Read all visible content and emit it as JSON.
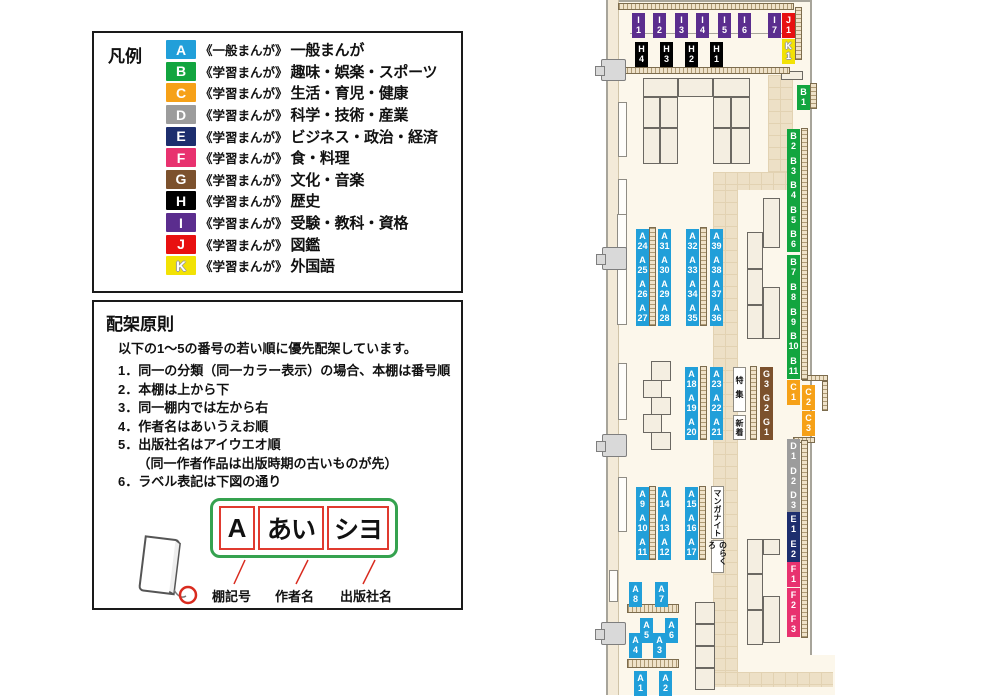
{
  "legend": {
    "title": "凡例",
    "items": [
      {
        "code": "A",
        "color": "#219FD9",
        "series": "《一般まんが》",
        "label": "一般まんが",
        "outlined": false
      },
      {
        "code": "B",
        "color": "#12A53F",
        "series": "《学習まんが》",
        "label": "趣味・娯楽・スポーツ",
        "outlined": false
      },
      {
        "code": "C",
        "color": "#F6A118",
        "series": "《学習まんが》",
        "label": "生活・育児・健康",
        "outlined": false
      },
      {
        "code": "D",
        "color": "#9C9C9C",
        "series": "《学習まんが》",
        "label": "科学・技術・産業",
        "outlined": false
      },
      {
        "code": "E",
        "color": "#1D2E6E",
        "series": "《学習まんが》",
        "label": "ビジネス・政治・経済",
        "outlined": false
      },
      {
        "code": "F",
        "color": "#E8326F",
        "series": "《学習まんが》",
        "label": "食・料理",
        "outlined": false
      },
      {
        "code": "G",
        "color": "#7C512D",
        "series": "《学習まんが》",
        "label": "文化・音楽",
        "outlined": false
      },
      {
        "code": "H",
        "color": "#000000",
        "series": "《学習まんが》",
        "label": "歴史",
        "outlined": false
      },
      {
        "code": "I",
        "color": "#5B2D8E",
        "series": "《学習まんが》",
        "label": "受験・教科・資格",
        "outlined": false
      },
      {
        "code": "J",
        "color": "#E81010",
        "series": "《学習まんが》",
        "label": "図鑑",
        "outlined": false
      },
      {
        "code": "K",
        "color": "#F2E205",
        "series": "《学習まんが》",
        "label": "外国語",
        "outlined": true
      }
    ]
  },
  "principles": {
    "title": "配架原則",
    "intro": "以下の1～5の番号の若い順に優先配架しています。",
    "items": [
      "1．同一の分類（同一カラー表示）の場合、本棚は番号順",
      "2．本棚は上から下",
      "3．同一棚内では左から右",
      "4．作者名はあいうえお順",
      "5．出版社名はアイウエオ順",
      "　　（同一作者作品は出版時期の古いものが先）",
      "6．ラベル表記は下図の通り"
    ],
    "label_example": {
      "shelf_code": "A",
      "author": "あい",
      "publisher": "シヨ",
      "captions": [
        "棚記号",
        "作者名",
        "出版社名"
      ]
    }
  },
  "map": {
    "categories": {
      "A": "#219FD9",
      "B": "#12A53F",
      "C": "#F6A118",
      "D": "#9C9C9C",
      "E": "#1D2E6E",
      "F": "#E8326F",
      "G": "#7C512D",
      "H": "#000000",
      "I": "#5B2D8E",
      "J": "#E81010",
      "K": "#F2E205"
    },
    "shelf_labels": [
      {
        "id": "I1",
        "x": 632,
        "y": 13
      },
      {
        "id": "I2",
        "x": 653,
        "y": 13
      },
      {
        "id": "I3",
        "x": 675,
        "y": 13
      },
      {
        "id": "I4",
        "x": 696,
        "y": 13
      },
      {
        "id": "I5",
        "x": 718,
        "y": 13
      },
      {
        "id": "I6",
        "x": 738,
        "y": 13
      },
      {
        "id": "I7",
        "x": 768,
        "y": 13
      },
      {
        "id": "J1",
        "x": 782,
        "y": 13
      },
      {
        "id": "K1",
        "x": 782,
        "y": 39
      },
      {
        "id": "H4",
        "x": 635,
        "y": 42
      },
      {
        "id": "H3",
        "x": 660,
        "y": 42
      },
      {
        "id": "H2",
        "x": 685,
        "y": 42
      },
      {
        "id": "H1",
        "x": 710,
        "y": 42
      },
      {
        "id": "B1",
        "x": 797,
        "y": 85
      },
      {
        "id": "B2",
        "x": 787,
        "y": 129
      },
      {
        "id": "B3",
        "x": 787,
        "y": 154
      },
      {
        "id": "B4",
        "x": 787,
        "y": 178
      },
      {
        "id": "B5",
        "x": 787,
        "y": 203
      },
      {
        "id": "B6",
        "x": 787,
        "y": 227
      },
      {
        "id": "B7",
        "x": 787,
        "y": 255
      },
      {
        "id": "B8",
        "x": 787,
        "y": 280
      },
      {
        "id": "B9",
        "x": 787,
        "y": 305
      },
      {
        "id": "B10",
        "x": 787,
        "y": 329
      },
      {
        "id": "B11",
        "x": 787,
        "y": 354
      },
      {
        "id": "C1",
        "x": 787,
        "y": 380
      },
      {
        "id": "C2",
        "x": 802,
        "y": 385
      },
      {
        "id": "C3",
        "x": 802,
        "y": 411
      },
      {
        "id": "D1",
        "x": 787,
        "y": 439
      },
      {
        "id": "D2",
        "x": 787,
        "y": 464
      },
      {
        "id": "D3",
        "x": 787,
        "y": 488
      },
      {
        "id": "E1",
        "x": 787,
        "y": 512
      },
      {
        "id": "E2",
        "x": 787,
        "y": 537
      },
      {
        "id": "F1",
        "x": 787,
        "y": 562
      },
      {
        "id": "F2",
        "x": 787,
        "y": 588
      },
      {
        "id": "F3",
        "x": 787,
        "y": 612
      },
      {
        "id": "A24",
        "x": 636,
        "y": 229
      },
      {
        "id": "A31",
        "x": 658,
        "y": 229
      },
      {
        "id": "A25",
        "x": 636,
        "y": 253
      },
      {
        "id": "A30",
        "x": 658,
        "y": 253
      },
      {
        "id": "A26",
        "x": 636,
        "y": 277
      },
      {
        "id": "A29",
        "x": 658,
        "y": 277
      },
      {
        "id": "A27",
        "x": 636,
        "y": 301
      },
      {
        "id": "A28",
        "x": 658,
        "y": 301
      },
      {
        "id": "A32",
        "x": 686,
        "y": 229
      },
      {
        "id": "A39",
        "x": 710,
        "y": 229
      },
      {
        "id": "A33",
        "x": 686,
        "y": 253
      },
      {
        "id": "A38",
        "x": 710,
        "y": 253
      },
      {
        "id": "A34",
        "x": 686,
        "y": 277
      },
      {
        "id": "A37",
        "x": 710,
        "y": 277
      },
      {
        "id": "A35",
        "x": 686,
        "y": 301
      },
      {
        "id": "A36",
        "x": 710,
        "y": 301
      },
      {
        "id": "A18",
        "x": 685,
        "y": 367
      },
      {
        "id": "A23",
        "x": 710,
        "y": 367
      },
      {
        "id": "A19",
        "x": 685,
        "y": 391
      },
      {
        "id": "A22",
        "x": 710,
        "y": 391
      },
      {
        "id": "A20",
        "x": 685,
        "y": 415
      },
      {
        "id": "A21",
        "x": 710,
        "y": 415
      },
      {
        "id": "G3",
        "x": 760,
        "y": 367
      },
      {
        "id": "G2",
        "x": 760,
        "y": 391
      },
      {
        "id": "G1",
        "x": 760,
        "y": 415
      },
      {
        "id": "A9",
        "x": 636,
        "y": 487
      },
      {
        "id": "A14",
        "x": 658,
        "y": 487
      },
      {
        "id": "A10",
        "x": 636,
        "y": 511
      },
      {
        "id": "A13",
        "x": 658,
        "y": 511
      },
      {
        "id": "A11",
        "x": 636,
        "y": 535
      },
      {
        "id": "A12",
        "x": 658,
        "y": 535
      },
      {
        "id": "A15",
        "x": 685,
        "y": 487
      },
      {
        "id": "A16",
        "x": 685,
        "y": 511
      },
      {
        "id": "A17",
        "x": 685,
        "y": 535
      },
      {
        "id": "A8",
        "x": 629,
        "y": 582
      },
      {
        "id": "A7",
        "x": 655,
        "y": 582
      },
      {
        "id": "A5",
        "x": 640,
        "y": 618
      },
      {
        "id": "A6",
        "x": 665,
        "y": 618
      },
      {
        "id": "A4",
        "x": 629,
        "y": 633
      },
      {
        "id": "A3",
        "x": 653,
        "y": 633
      },
      {
        "id": "A1",
        "x": 634,
        "y": 671
      },
      {
        "id": "A2",
        "x": 659,
        "y": 671
      }
    ],
    "area_notes": [
      {
        "text": "特集",
        "x": 733,
        "y": 367,
        "w": 13,
        "h": 45,
        "ls": 6
      },
      {
        "text": "新着",
        "x": 733,
        "y": 415,
        "w": 13,
        "h": 25,
        "ls": 1
      },
      {
        "text": "マンガナイト",
        "x": 711,
        "y": 486,
        "w": 13,
        "h": 53,
        "ls": 0
      },
      {
        "text": "のらくろ",
        "x": 711,
        "y": 540,
        "w": 13,
        "h": 33,
        "ls": 0
      }
    ]
  }
}
